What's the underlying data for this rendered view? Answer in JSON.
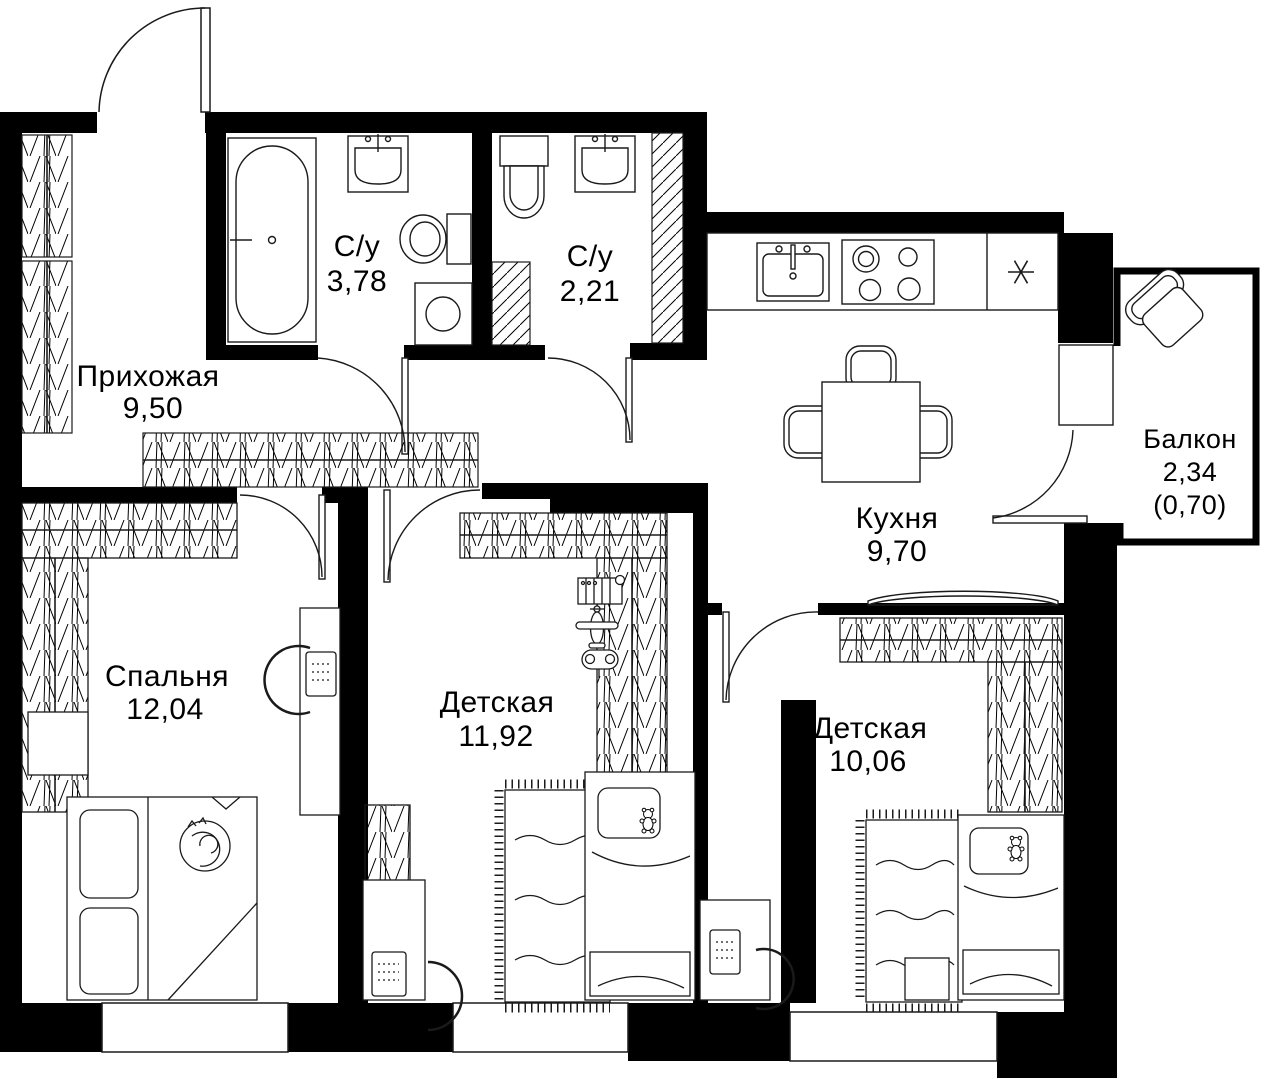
{
  "plan": {
    "type": "apartment-floor-plan",
    "rooms": [
      {
        "id": "hallway",
        "name": "Прихожая",
        "area": "9,50"
      },
      {
        "id": "bathroom-1",
        "name": "С/у",
        "area": "3,78"
      },
      {
        "id": "bathroom-2",
        "name": "С/у",
        "area": "2,21"
      },
      {
        "id": "kitchen",
        "name": "Кухня",
        "area": "9,70"
      },
      {
        "id": "balcony",
        "name": "Балкон",
        "area": "2,34",
        "area_secondary": "(0,70)"
      },
      {
        "id": "bedroom",
        "name": "Спальня",
        "area": "12,04"
      },
      {
        "id": "kids-room-1",
        "name": "Детская",
        "area": "11,92"
      },
      {
        "id": "kids-room-2",
        "name": "Детская",
        "area": "10,06"
      }
    ],
    "colors": {
      "wall": "#000000",
      "background": "#ffffff",
      "line": "#111111"
    },
    "icons": [
      "bathtub-icon",
      "sink-icon",
      "toilet-icon",
      "washing-machine-icon",
      "stove-icon",
      "fridge-icon",
      "dining-table",
      "dining-chair-icon",
      "kitchen-sofa-icon",
      "armchair-icon",
      "bed-icon",
      "pillow",
      "cat-icon",
      "teddy-bear-icon",
      "rug-icon",
      "desk",
      "desk-chair-icon",
      "laptop-icon",
      "wardrobe-icon",
      "duct-icon",
      "window",
      "door-arc",
      "nightstand",
      "piano-icon",
      "airplane-icon",
      "gamepad-icon"
    ]
  }
}
